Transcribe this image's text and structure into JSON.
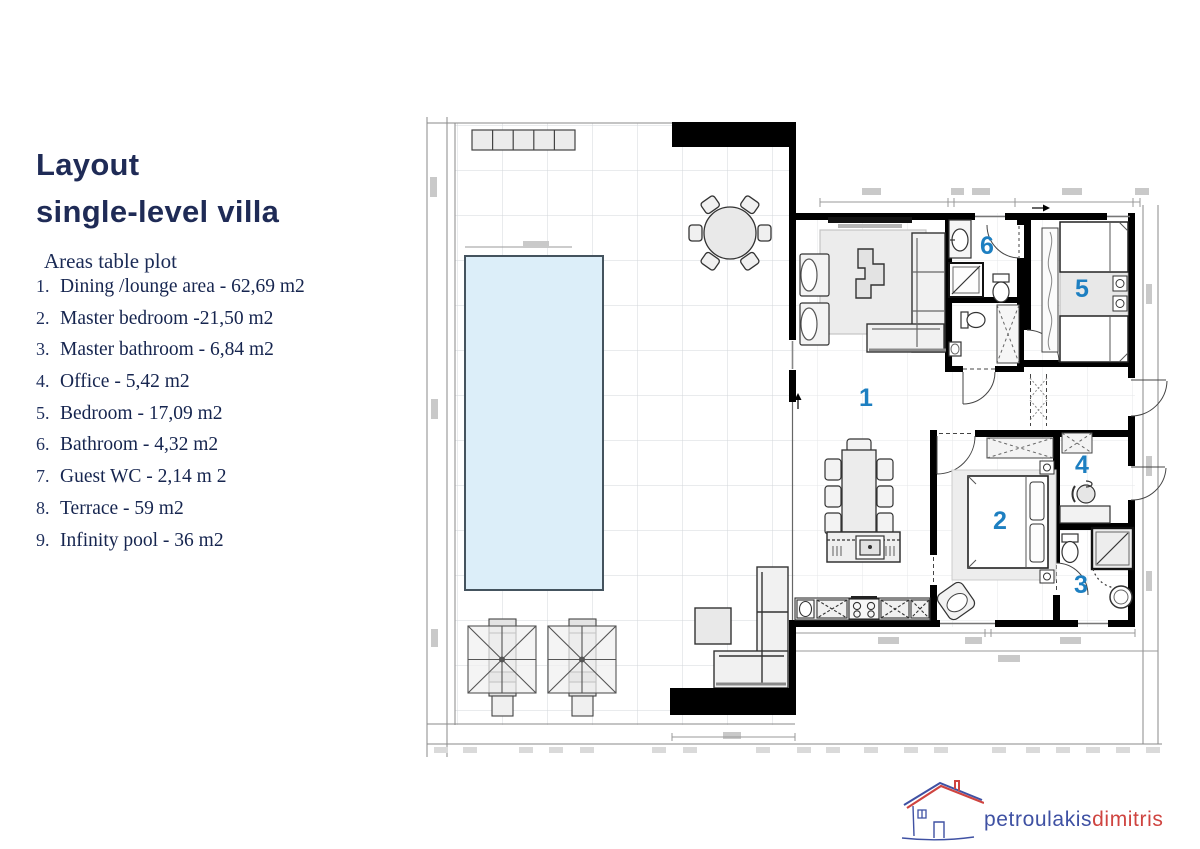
{
  "title": {
    "line1": "Layout",
    "line2": "single-level villa"
  },
  "areas_table": {
    "heading": "Areas table plot",
    "items": [
      {
        "num": "1.",
        "text": "Dining /lounge area - 62,69 m2"
      },
      {
        "num": "2.",
        "text": "Master bedroom -21,50 m2"
      },
      {
        "num": "3.",
        "text": "Master bathroom - 6,84 m2"
      },
      {
        "num": "4.",
        "text": "Office - 5,42 m2"
      },
      {
        "num": "5.",
        "text": "Bedroom - 17,09 m2"
      },
      {
        "num": "6.",
        "text": "Bathroom - 4,32 m2"
      },
      {
        "num": "7.",
        "text": "Guest WC - 2,14 m 2"
      },
      {
        "num": "8.",
        "text": "Terrace - 59 m2"
      },
      {
        "num": "9.",
        "text": "Infinity pool - 36 m2"
      }
    ]
  },
  "plan": {
    "room_numbers": [
      {
        "num": "1",
        "room": "dining-lounge-area"
      },
      {
        "num": "2",
        "room": "master-bedroom"
      },
      {
        "num": "3",
        "room": "master-bathroom"
      },
      {
        "num": "4",
        "room": "office"
      },
      {
        "num": "5",
        "room": "bedroom"
      },
      {
        "num": "6",
        "room": "bathroom"
      }
    ],
    "colors": {
      "room_number": "#1d7fc1",
      "pool_fill": "#dceef9",
      "wall": "#000000",
      "grid": "#d3d7db"
    }
  },
  "logo": {
    "icon": "house-sketch-icon",
    "name_blue": "petroulakis",
    "name_red": "dimitris",
    "blue": "#3f51a3",
    "red": "#cf4440"
  }
}
